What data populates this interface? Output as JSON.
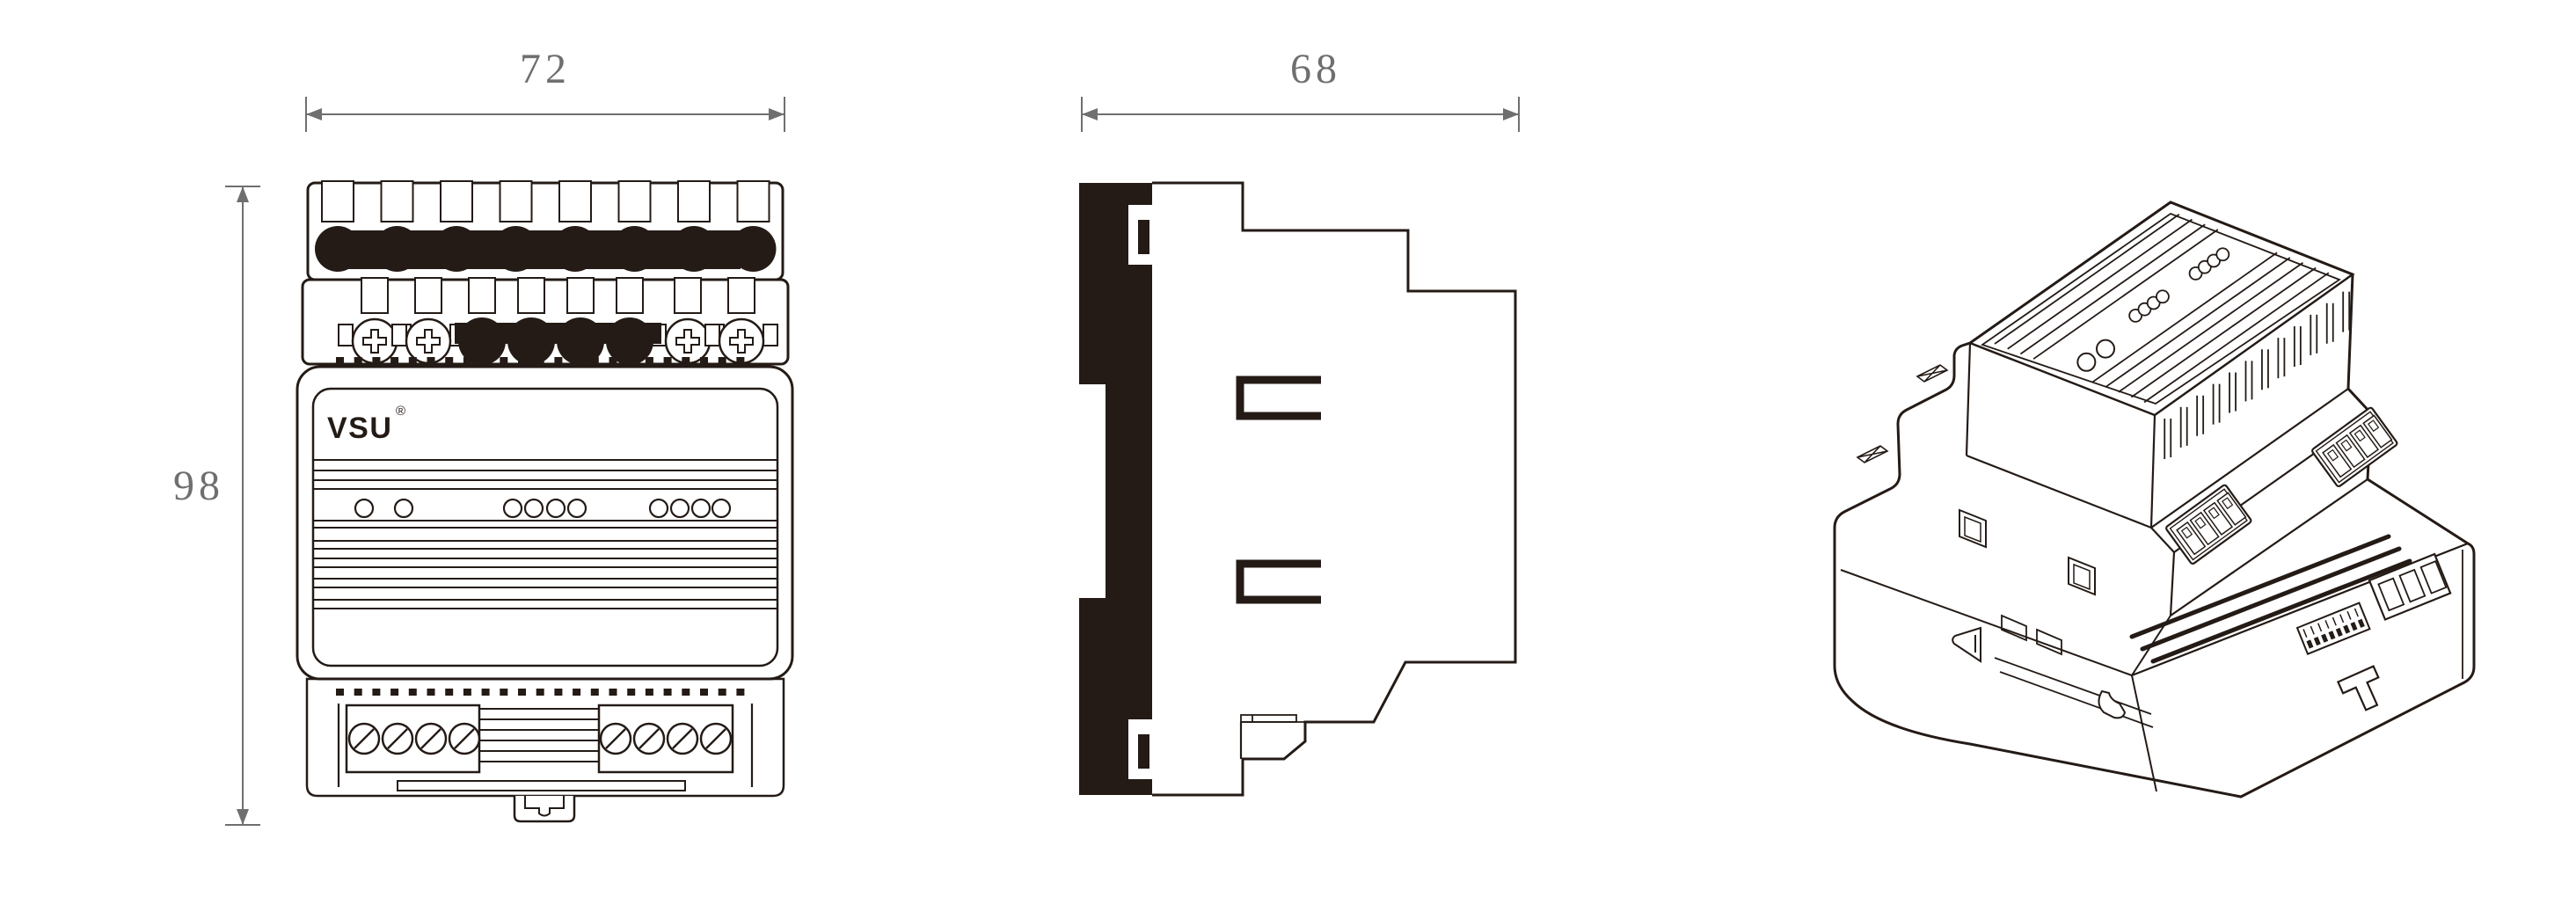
{
  "drawing": {
    "title": "DIN-rail module technical drawing",
    "colors": {
      "line": "#241b16",
      "dimension": "#6f6f6f",
      "background": "#ffffff"
    },
    "brand": {
      "logo": "VSU",
      "registered_mark": "®"
    },
    "views": {
      "front": {
        "label": "front-view",
        "dimension_width": {
          "label": "72"
        },
        "dimension_height": {
          "label": "98"
        },
        "top_terminal_count": 8,
        "row2": {
          "screw_terminals": [
            426,
            487,
            782,
            843
          ],
          "black_terminals": [
            548,
            604,
            660,
            716
          ]
        },
        "led_groups": [
          [
            414,
            459
          ],
          [
            583,
            607,
            632,
            656
          ],
          [
            749,
            773,
            797,
            820
          ]
        ],
        "panel_lines_upper": [
          523,
          535,
          546,
          556
        ],
        "panel_lines_lower": [
          592,
          600,
          615,
          624,
          635,
          645,
          658,
          668,
          682,
          692
        ],
        "bottom_screws_left": [
          414,
          452,
          490,
          528
        ],
        "bottom_screws_right": [
          700,
          738,
          776,
          814
        ]
      },
      "side": {
        "label": "side-view",
        "dimension_depth": {
          "label": "68"
        }
      },
      "isometric": {
        "label": "isometric-view",
        "top_ribs_front": [
          0.09,
          0.16,
          0.23,
          0.3
        ],
        "top_ribs_back": [
          0.62,
          0.69,
          0.76,
          0.83,
          0.9
        ],
        "top_holes_large_t": [
          0.12,
          0.215
        ],
        "top_holes_small_t": [
          [
            0.42,
            0.465,
            0.51,
            0.555
          ],
          [
            0.72,
            0.765,
            0.81,
            0.855
          ]
        ],
        "vent_slot_count": 12
      }
    }
  }
}
